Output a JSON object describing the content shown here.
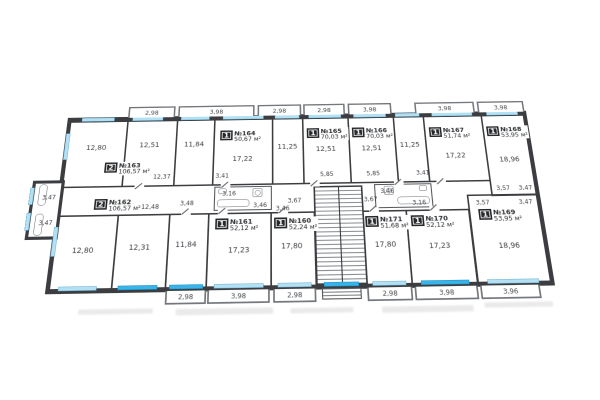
{
  "plan_title": "floor-plan",
  "colors": {
    "wall": "#3b3d40",
    "window_light": "#b4e0f3",
    "window_bright": "#39b4e8",
    "badge_bg": "#26282b",
    "text": "#3d3f43"
  },
  "apartments": [
    {
      "badge": "2",
      "number": "№163",
      "area": "106,57 м²"
    },
    {
      "badge": "1",
      "number": "№164",
      "area": "50,67 м²"
    },
    {
      "badge": "1",
      "number": "№165",
      "area": "70,03 м²"
    },
    {
      "badge": "1",
      "number": "№166",
      "area": "70,03 м²"
    },
    {
      "badge": "1",
      "number": "№167",
      "area": "51,74 м²"
    },
    {
      "badge": "1",
      "number": "№168",
      "area": "53,95 м²"
    },
    {
      "badge": "2",
      "number": "№162",
      "area": "106,57 м²"
    },
    {
      "badge": "1",
      "number": "№161",
      "area": "52,12 м²"
    },
    {
      "badge": "1",
      "number": "№160",
      "area": "52,24 м²"
    },
    {
      "badge": "1",
      "number": "№171",
      "area": "51,68 м²"
    },
    {
      "badge": "1",
      "number": "№170",
      "area": "52,12 м²"
    },
    {
      "badge": "1",
      "number": "№169",
      "area": "53,95 м²"
    }
  ],
  "rooms_top": [
    "12,80",
    "12,51",
    "11,84",
    "17,22",
    "11,25",
    "12,51",
    "12,51",
    "11,25",
    "17,22",
    "18,96"
  ],
  "rooms_bottom": [
    "12,80",
    "12,31",
    "11,84",
    "17,23",
    "17,80",
    "17,80",
    "17,23",
    "18,96"
  ],
  "dims": {
    "hall163": "12,37",
    "hall162": "12,48",
    "hall165": "5,85",
    "hall166": "5,85",
    "stair_l": "3,67",
    "stair_r": "3,67",
    "h164": "3,41",
    "h167": "3,41",
    "h168": "3,57",
    "h169": "3,57",
    "wc1a": "3,16",
    "wc1b": "3,46",
    "wc2a": "3,46",
    "wc2b": "3,16",
    "wc161": "3,46",
    "wc162": "3,48",
    "annex_a": "3,47",
    "annex_b": "3,47",
    "wc168": "3,47",
    "wc169": "3,47"
  },
  "balconies": {
    "top": [
      "2,98",
      "3,98",
      "2,98",
      "2,98",
      "3,98",
      "3,98",
      "3,98"
    ],
    "bottom": [
      "2,98",
      "3,98",
      "2,98",
      "2,98",
      "3,98",
      "3,96"
    ]
  }
}
